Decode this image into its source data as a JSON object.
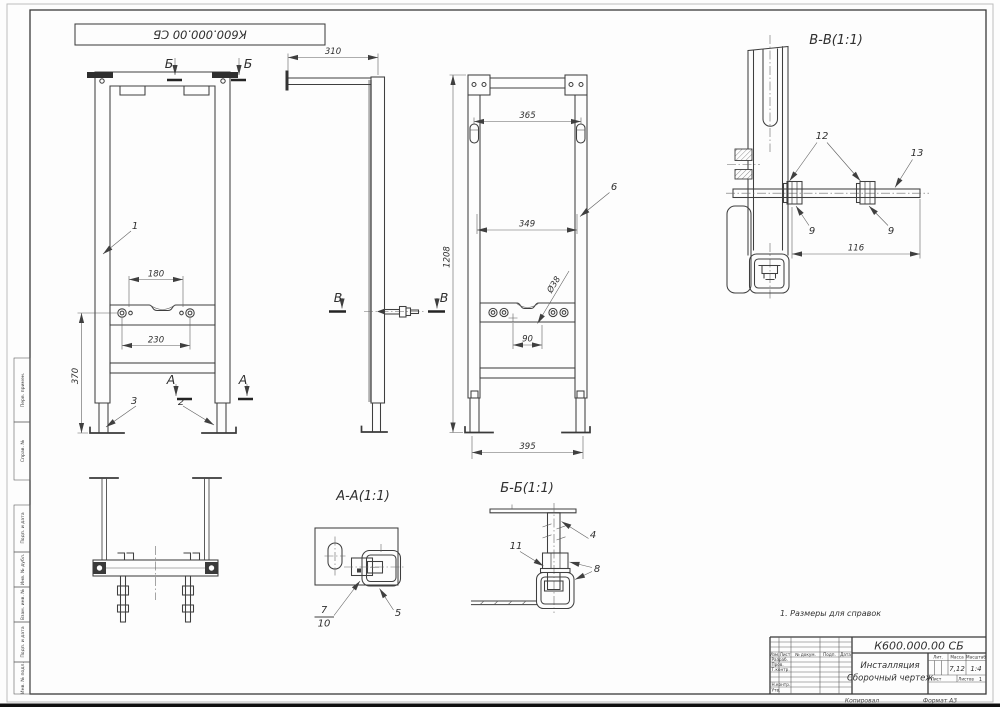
{
  "sheet": {
    "top_stamp": "К600.000.00 СБ",
    "note": "1. Размеры для справок"
  },
  "margin_fields": {
    "perv_primen": "Перв. примен.",
    "sprav_no": "Справ. №",
    "podp_data_1": "Подп. и дата",
    "inv_no_dubl": "Инв. № дубл.",
    "vzam_inv_no": "Взам. инв. №",
    "podp_data_2": "Подп. и дата",
    "inv_no_podl": "Инв. № подл."
  },
  "dimensions": {
    "d180": "180",
    "d230": "230",
    "d370": "370",
    "d310": "310",
    "d365": "365",
    "d349": "349",
    "d1208": "1208",
    "d90": "90",
    "dia38": "Ø38",
    "d395": "395",
    "d116": "116"
  },
  "callouts": {
    "c1": "1",
    "c2": "2",
    "c3": "3",
    "c4": "4",
    "c5": "5",
    "c6": "6",
    "c7": "7",
    "c8": "8",
    "c9": "9",
    "c10": "10",
    "c11": "11",
    "c12": "12",
    "c13": "13"
  },
  "section_marks": {
    "a": "А",
    "b": "Б",
    "v": "В"
  },
  "section_titles": {
    "vv": "В-В(1:1)",
    "aa": "А-А(1:1)",
    "bb": "Б-Б(1:1)"
  },
  "title_block": {
    "doc_number": "К600.000.00 СБ",
    "product_name": "Инсталляция",
    "doc_type": "Сборочный чертеж",
    "lit_label": "Лит.",
    "mass_label": "Масса",
    "scale_label": "Масштаб",
    "mass_value": "7,12",
    "scale_value": "1:4",
    "sheet_label": "Лист",
    "sheets_label": "Листов",
    "sheets_value": "1",
    "col_izm": "Изм.",
    "col_list": "Лист",
    "col_doc": "№ докум.",
    "col_podp": "Подп.",
    "col_data": "Дата",
    "row_razrab": "Разраб.",
    "row_prov": "Пров.",
    "row_tkontr": "Т.контр.",
    "row_nkontr": "Н.контр.",
    "row_utv": "Утв.",
    "footer_copied": "Копировал",
    "footer_format": "Формат А3"
  }
}
